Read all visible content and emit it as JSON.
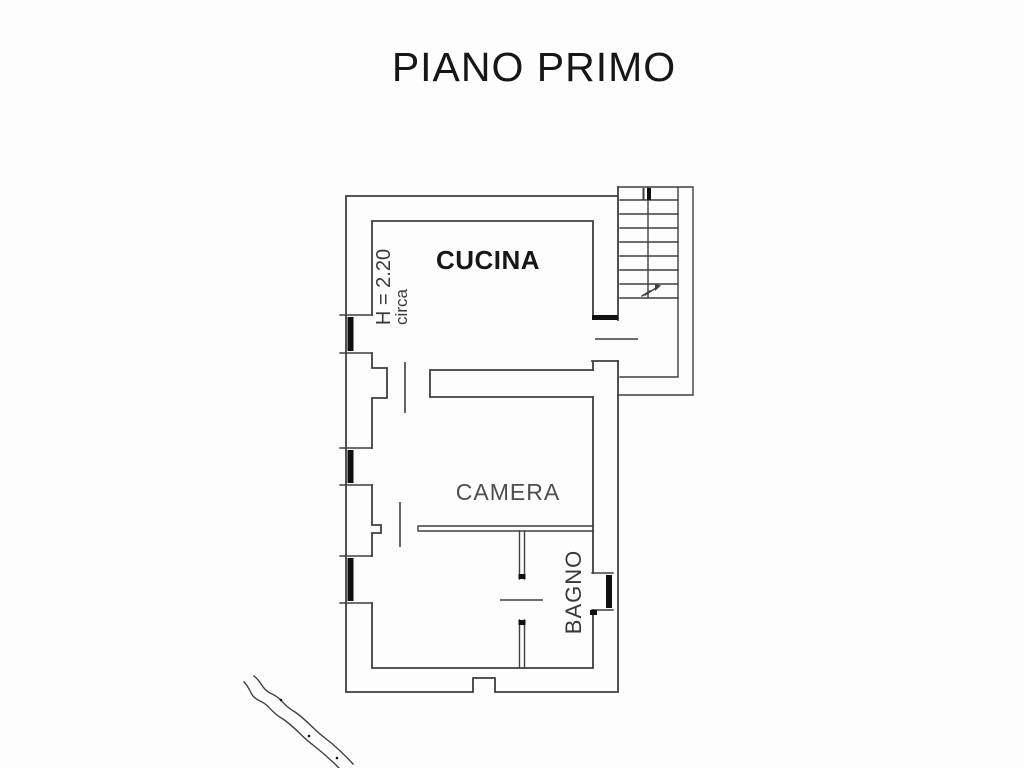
{
  "title": "PIANO PRIMO",
  "rooms": {
    "cucina": {
      "label": "CUCINA"
    },
    "camera": {
      "label": "CAMERA"
    },
    "bagno": {
      "label": "BAGNO"
    }
  },
  "annotations": {
    "ceiling_height": "H = 2.20",
    "ceiling_height_qualifier": "circa"
  },
  "colors": {
    "background": "#fdfdfd",
    "line": "#3f3f3f",
    "ink": "#101010",
    "text_dark": "#161616",
    "text_gray": "#4e4e4e",
    "text_mid": "#383838"
  }
}
